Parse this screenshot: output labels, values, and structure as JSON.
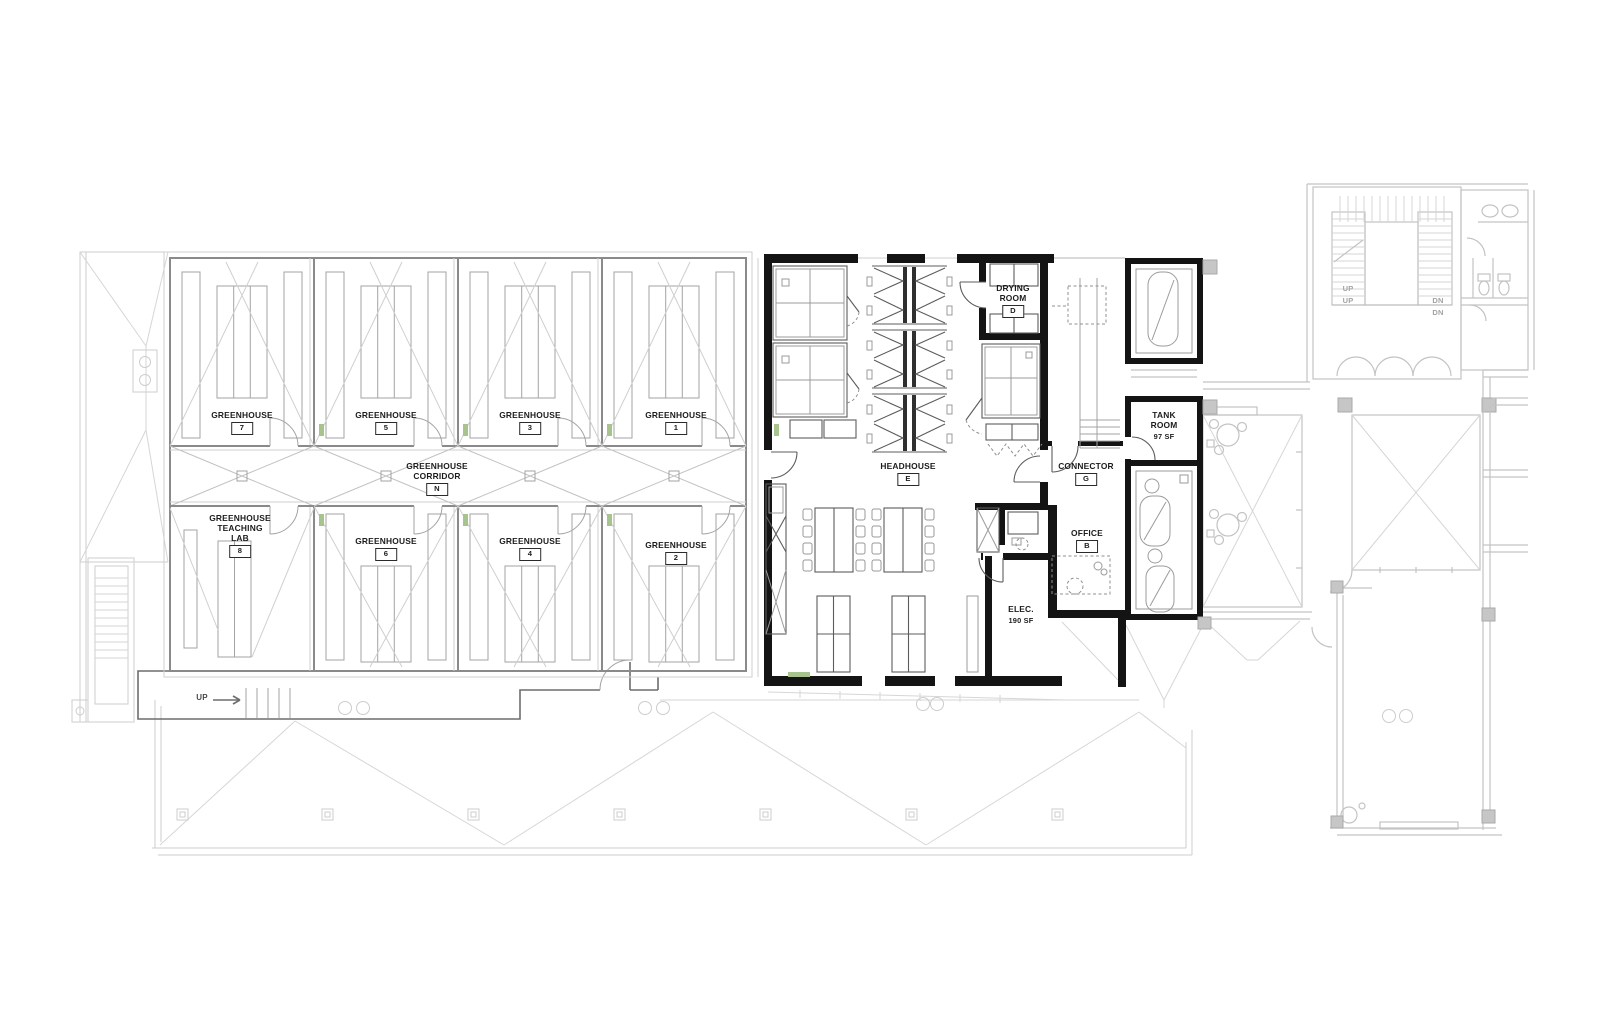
{
  "drawing": {
    "kind": "architectural-floor-plan"
  },
  "rooms": {
    "greenhouse7": {
      "name": "GREENHOUSE",
      "tag": "7"
    },
    "greenhouse5": {
      "name": "GREENHOUSE",
      "tag": "5"
    },
    "greenhouse3": {
      "name": "GREENHOUSE",
      "tag": "3"
    },
    "greenhouse1": {
      "name": "GREENHOUSE",
      "tag": "1"
    },
    "corridor": {
      "line1": "GREENHOUSE",
      "line2": "CORRIDOR",
      "tag": "N"
    },
    "teachingLab": {
      "line1": "GREENHOUSE",
      "line2": "TEACHING",
      "line3": "LAB",
      "tag": "8"
    },
    "greenhouse6": {
      "name": "GREENHOUSE",
      "tag": "6"
    },
    "greenhouse4": {
      "name": "GREENHOUSE",
      "tag": "4"
    },
    "greenhouse2": {
      "name": "GREENHOUSE",
      "tag": "2"
    },
    "headhouse": {
      "name": "HEADHOUSE",
      "tag": "E"
    },
    "dryingRoom": {
      "line1": "DRYING",
      "line2": "ROOM",
      "tag": "D"
    },
    "connector": {
      "name": "CONNECTOR",
      "tag": "G"
    },
    "tankRoom": {
      "line1": "TANK",
      "line2": "ROOM",
      "area": "97 SF"
    },
    "office": {
      "name": "OFFICE",
      "tag": "B"
    },
    "elec": {
      "name": "ELEC.",
      "area": "190 SF"
    }
  },
  "annotations": {
    "up": "UP",
    "dn": "DN"
  },
  "colors": {
    "wall": "#141414",
    "greenhouse_line": "#8a8a8a",
    "existing_line": "#c3c3c3",
    "door_mark_green": "#a8c48e"
  }
}
